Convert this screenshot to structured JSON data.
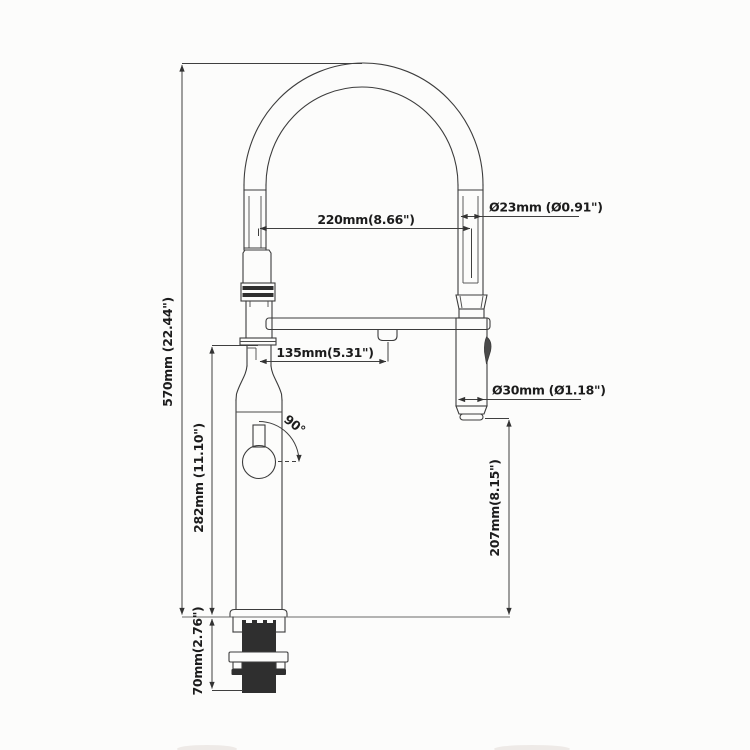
{
  "drawing": {
    "title": "pull-down-faucet-dimension-drawing",
    "line_color": "#3c3c3c",
    "background": "#fcfcfb",
    "dimensions": {
      "spout_reach": "220mm(8.66\")",
      "spout_tube_diameter": "Ø23mm (Ø0.91\")",
      "overall_height": "570mm (22.44\")",
      "dock_offset": "135mm(5.31\")",
      "spray_head_diameter": "Ø30mm (Ø1.18\")",
      "body_height": "282mm (11.10\")",
      "spray_head_clearance": "207mm(8.15\")",
      "under_counter_depth": "70mm(2.76\")",
      "handle_swing_angle": "90°"
    }
  }
}
